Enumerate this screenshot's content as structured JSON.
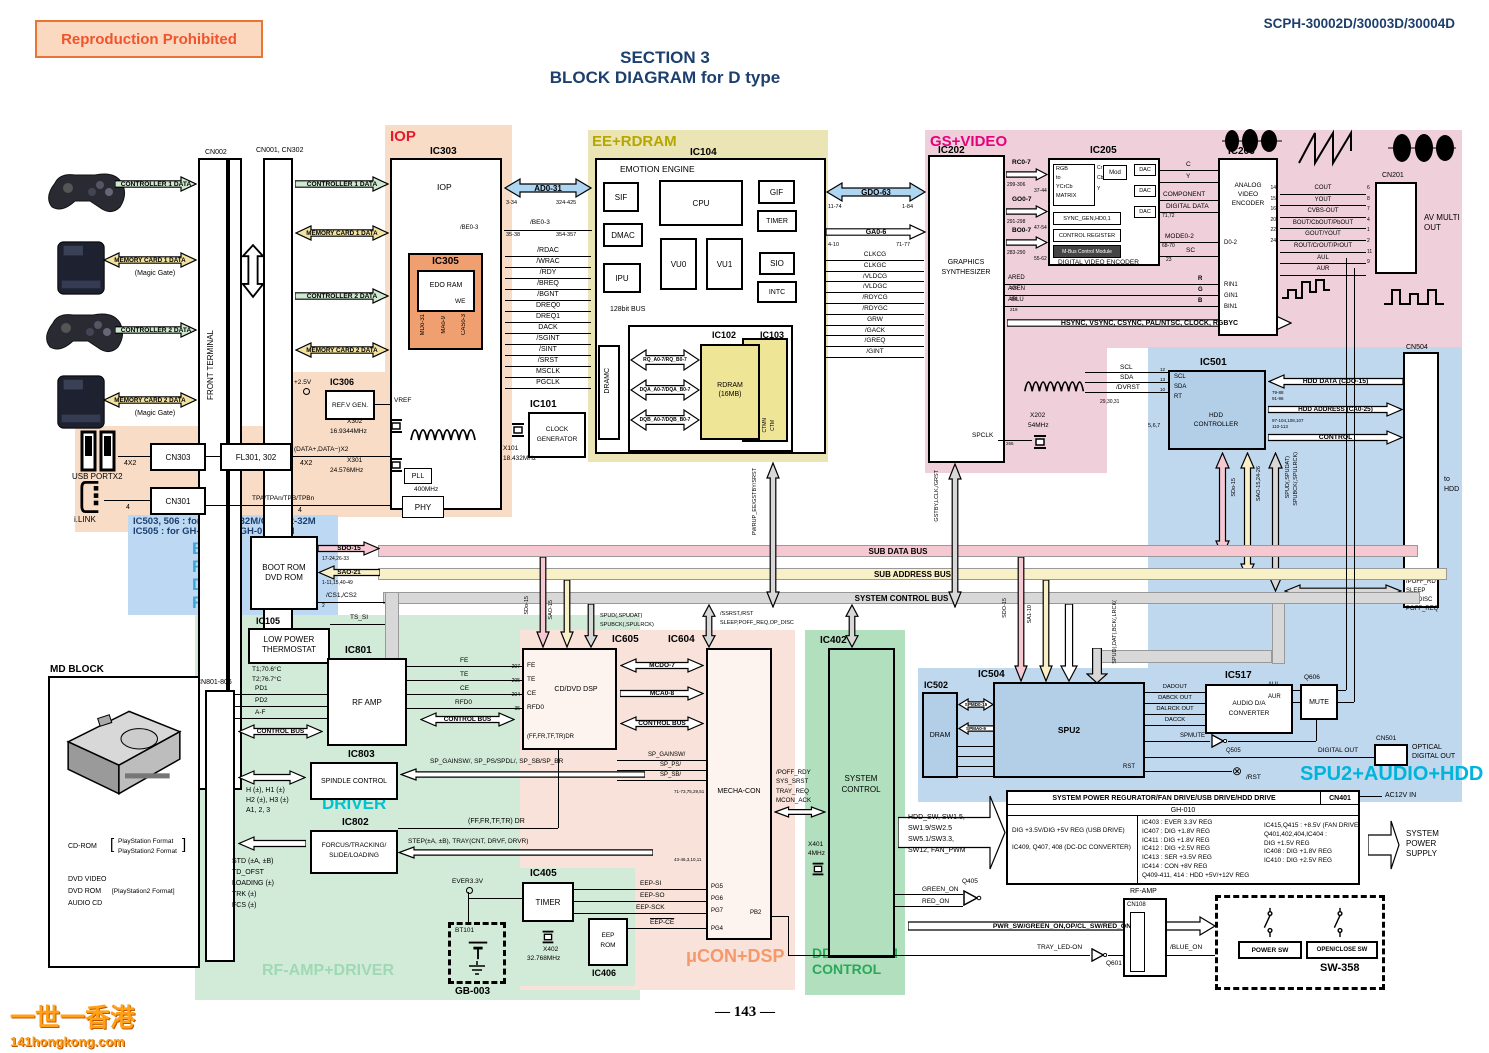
{
  "header": {
    "stamp": "Reproduction Prohibited",
    "model": "SCPH-30002D/30003D/30004D",
    "title1": "SECTION 3",
    "title2": "BLOCK DIAGRAM for D type",
    "page": "— 143 —",
    "wm1": "一世一香港",
    "wm2": "141hongkong.com"
  },
  "regions": {
    "iop": "IOP",
    "ee": "EE+RDRAM",
    "gs": "GS+VIDEO",
    "boot": [
      "BOOT",
      "ROM",
      "DVD",
      "ROM"
    ],
    "spu": "SPU2+AUDIO+HDD",
    "driver": "DRIVER",
    "rfamp": "RF-AMP+DRIVER",
    "ucon": "μCON+DSP",
    "dd1": "DD+SYSTEM",
    "dd2": "CONTROL",
    "note1": "IC503, 506 : for GH-010-32M/GH-012-32M",
    "note2": "IC505 :         for GH-010-64M/GH-012-64M"
  },
  "left": {
    "ctl1": "CONTROLLER 1 DATA",
    "mc1": "MEMORY CARD 1 DATA",
    "magic": "(Magic Gate)",
    "ctl2": "CONTROLLER 2 DATA",
    "mc2": "MEMORY CARD 2 DATA",
    "cn002": "CN002",
    "cn001": "CN001, CN302",
    "ft": "FRONT TERMINAL",
    "usb": "USB PORTX2",
    "ilink": "i.LINK",
    "cn303": "CN303",
    "fl": "FL301, 302",
    "cn301": "CN301",
    "datax2": "(DATA+,DATA−)X2",
    "x42": "4X2",
    "four": "4",
    "tpa": "TPA/TPAn/TPB/TPBn"
  },
  "iop": {
    "ic303": "IC303",
    "name": "IOP",
    "ic305": "IC305",
    "edo": "EDO RAM",
    "we": "WE",
    "md": "MDo-31",
    "ma": "MAo-9",
    "cas": "CASo-3",
    "vref": "VREF",
    "v25": "+2.5V",
    "ic306": "IC306",
    "refv": "REF.V GEN.",
    "x302": "X302",
    "x302f": "16.9344MHz",
    "x301": "X301",
    "x301f": "24.576MHz",
    "pll": "PLL",
    "mhz": "400MHz",
    "phy": "PHY",
    "ad": "AD0-31",
    "adp1": "3-34",
    "adp2": "324-425",
    "be": "/BE0-3",
    "bep1": "35-38",
    "bep3": "354-357",
    "signals": [
      "/RDAC",
      "/WRAC",
      "/RDY",
      "/BREQ",
      "/BGNT",
      "DREQ0",
      "DREQ1",
      "DACK",
      "/SGINT",
      "/SINT",
      "/SRST",
      "MSCLK",
      "PGCLK"
    ],
    "ic101": "IC101",
    "clk1": "CLOCK",
    "clk2": "GENERATOR",
    "x101": "X101",
    "x101f": "18.432MHz"
  },
  "ee": {
    "ic104": "IC104",
    "name": "EMOTION ENGINE",
    "sif": "SIF",
    "cpu": "CPU",
    "gif": "GIF",
    "timer": "TIMER",
    "dmac": "DMAC",
    "vu0": "VU0",
    "vu1": "VU1",
    "sio": "SIO",
    "ipu": "IPU",
    "intc": "INTC",
    "bus": "128bit BUS",
    "dramc": "DRAMC",
    "ic102": "IC102",
    "ic103": "IC103",
    "rdram1": "RDRAM",
    "rdram2": "(16MB)",
    "rq": "RQ_A0-7/RQ_B0-7",
    "dqa": "DQA_A0-7/DQA_B0-7",
    "dqb": "DQB_A0-7/DQB_B0-7",
    "ctmn": "CTMN",
    "ctm": "CTM"
  },
  "gsif": {
    "gdo": "GDO-63",
    "g1": "11-74",
    "g2": "1-84",
    "ga": "GA0-6",
    "g3": "4-10",
    "g4": "71-77",
    "signals": [
      "CLKCG",
      "CLKGC",
      "/VLDCG",
      "/VLDGC",
      "/RDYCG",
      "/RDYGC",
      "GRW",
      "/GACK",
      "/GREQ",
      "/GINT"
    ]
  },
  "gs": {
    "ic202": "IC202",
    "name1": "GRAPHICS",
    "name2": "SYNTHESIZER",
    "rc": "RC0-7",
    "rcp": "299-306",
    "rcp2": "37-44",
    "go": "GO0-7",
    "gop": "291-298",
    "gop2": "47-54",
    "bo": "BO0-7",
    "bop": "283-290",
    "bop2": "55-62",
    "ic205": "IC205",
    "mx1": "RGB",
    "mx2": "to",
    "mx3": "YCrCb",
    "mx4": "MATRIX",
    "mod": "Mod",
    "dac": "DAC",
    "cr": "Cr",
    "cb": "Cb",
    "yy": "Y",
    "sync": "SYNC_GEN,HD0,1",
    "creg": "CONTROL REGISTER",
    "mbus": "M-Bus Control Module",
    "dve": "DIGITAL VIDEO ENCODER",
    "oc": "C",
    "oy": "Y",
    "comp": "COMPONENT",
    "dd": "DIGITAL DATA",
    "ddp": "71,72",
    "mode": "MODE0-2",
    "modep": "68-70",
    "sc": "SC",
    "scp": "23",
    "p2931": "29,30,31",
    "ared": "ARED",
    "agen": "AGEN",
    "ablu": "ABLU",
    "ap1": "220",
    "ap2": "218",
    "ap3": "219",
    "r": "R",
    "g": "G",
    "b": "B",
    "hsync": "HSYNC, VSYNC, CSYNC, PAL/NTSC, CLOCK, RGBYC",
    "spclk": "SPCLK",
    "sp": "266",
    "x202": "X202",
    "x202f": "54MHz",
    "scl": "SCL",
    "sda": "SDA",
    "dvrst": "/DVRST"
  },
  "av": {
    "ic206": "IC206",
    "name1": "ANALOG",
    "name2": "VIDEO",
    "name3": "ENCODER",
    "d02": "D0-2",
    "rin": "RIN1",
    "gin": "GIN1",
    "bin": "BIN1",
    "outs": [
      "COUT",
      "YOUT",
      "CVBS-OUT",
      "BOUT/CbOUT/PbOUT",
      "GOUT/YOUT",
      "ROUT/CrOUT/PrOUT",
      "AUL",
      "AUR"
    ],
    "lp": [
      "14",
      "15",
      "16",
      "20",
      "22",
      "24"
    ],
    "cnp": [
      "6",
      "8",
      "7",
      "4",
      "1",
      "2",
      "11",
      "9"
    ],
    "cn201": "CN201",
    "avm1": "AV MULTI",
    "avm2": "OUT"
  },
  "hdd": {
    "ic501": "IC501",
    "name1": "HDD",
    "name2": "CONTROLLER",
    "scl": "SCL",
    "sda": "SDA",
    "rt": "RT",
    "p12": "12",
    "p13": "13",
    "p10": "10",
    "p567": "5,6,7",
    "data": "HDD DATA (CDO-15)",
    "datap": "79-88",
    "datap2": "91-96",
    "addr": "HDD ADDRESS (CA0-25)",
    "addrp": "97-104,108,107",
    "addrp2": "110-113",
    "ctl": "CONTROL",
    "cn504": "CN504",
    "to1": "to",
    "to2": "HDD",
    "sdo": "SDo-15",
    "sao": "SAO-15,24-26",
    "spud": "SPUD(,SPUDAT)",
    "spub": "SPUBCK(,SPULRCK)",
    "poff": [
      "/POFF_RDY",
      "SLEEP",
      "PO_DISC",
      "POFF_REQ"
    ]
  },
  "bus": {
    "data": "SUB DATA BUS",
    "addr": "SUB ADDRESS BUS",
    "ctl": "SYSTEM CONTROL BUS",
    "boot1": "BOOT ROM",
    "boot2": "DVD ROM",
    "sdo": "SDO-15",
    "sdop": "17-24,26-33",
    "sao": "SAO-21",
    "saop": "1-11,15,40-49",
    "cs": "/CS1,/CS2",
    "csp": "2",
    "tssi": "TS_SI",
    "pwrup": "PWRUP_EE/GSTBY/SRST",
    "gstby": "GSTBY,LCLK,/GRST",
    "sdo15": "SDo-15",
    "sao15": "SAO-15",
    "vsdo": "SDO-15",
    "vsa": "SA1-10",
    "vspud": "SPUD(,DAT(,BCK(,LRCK(",
    "spud605a": "SPUD(,SPUDAT)",
    "spud605b": "SPUBCK(,SPULRCK)",
    "ssrst": "/SSRST,/RST",
    "sleep": "SLEEP,POFF_REQ,OP_DISC"
  },
  "drv": {
    "ic105": "IC105",
    "lp1": "LOW POWER",
    "lp2": "THERMOSTAT",
    "t1": "T1;70.6°C",
    "t2": "T2;76.7°C",
    "cn801": "CN801-806",
    "ic801": "IC801",
    "rfamp": "RF AMP",
    "pd1": "PD1",
    "pd2": "PD2",
    "af": "A-F",
    "fe": "FE",
    "te": "TE",
    "ce": "CE",
    "rfd0": "RFD0",
    "cbus": "CONTROL BUS",
    "ic803": "IC803",
    "spindle": "SPINDLE CONTROL",
    "h1": "H (±), H1 (±)",
    "h2": "H2 (±), H3 (±)",
    "h3": "A1, 2, 3",
    "ic802": "IC802",
    "f1": "FORCUS/TRACKING/",
    "f2": "SLIDE/LOADING",
    "std": [
      "STD (±A, ±B)",
      "TD_OFST",
      "LOADING (±)",
      "TRK (±)",
      "FCS (±)"
    ],
    "spg": "SP_GAINSW/, SP_PS/SPDL/, SP_SB/SP_BR",
    "ffdr": "(FF,FR,TF,TR) DR",
    "step": "STEP(±A, ±B), TRAY(CNT, DRVF, DRVR)",
    "md": "MD BLOCK",
    "cdrom": "CD-ROM",
    "fmt1": "PlayStation Format",
    "fmt2": "PlayStation2 Format",
    "dvdv": "DVD VIDEO",
    "dvdr": "DVD ROM",
    "fmt3": "[PlayStation2 Format]",
    "acd": "AUDIO CD"
  },
  "dsp": {
    "ic605": "IC605",
    "name": "CD/DVD DSP",
    "fe": "FE",
    "te": "TE",
    "ce": "CE",
    "rfd0": "RFD0",
    "pins": [
      "207",
      "205",
      "204",
      "35"
    ],
    "ffdr": "(FF,FR,TF,TR)DR",
    "mcd": "MCDO-7",
    "mca": "MCA0-8",
    "cbus": "CONTROL BUS",
    "ic604": "IC604",
    "name2": "MECHA-CON",
    "p1": "71-73,75,29,51",
    "p2": "43-46,3,10,11",
    "spg1": "SP_GAINSW/",
    "spg2": "SP_PS/",
    "spg3": "SP_SB/",
    "poff": [
      "/POFF_RDY",
      "SYS_SRST",
      "TRAY_REQ",
      "MCON_ACK"
    ],
    "x401": "X401",
    "x401f": "4MHz",
    "pg5": "PG5",
    "pg6": "PG6",
    "pg7": "PG7",
    "pg4": "PG4",
    "pb2": "PB2",
    "eepsi": "EEP-SI",
    "eepso": "EEP-SO",
    "eepsck": "EEP-SCK",
    "eepce": "EEP-CE",
    "ic405": "IC405",
    "timer": "TIMER",
    "x402": "X402",
    "x402f": "32.768MHz",
    "ic406": "IC406",
    "eep1": "EEP",
    "eep2": "ROM",
    "bt": "BT101",
    "gb": "GB-003",
    "ever": "EVER3.3V"
  },
  "sys": {
    "ic402": "IC402",
    "n1": "SYSTEM",
    "n2": "CONTROL",
    "sw": [
      "HDD_SW, SW1.5,",
      "SW1.9/SW2.5",
      "SW5.1/SW3.3,",
      "SW12, FAN_PWM"
    ],
    "green": "GREEN_ON",
    "red": "RED_ON",
    "q405": "Q405",
    "pwr": "PWR_SW/GREEN_ON,OP/CL_SW/RED_ON",
    "tray": "TRAY_LED-ON",
    "q601": "Q601",
    "blue": "/BLUE_ON",
    "rfamp": "RF-AMP",
    "cn108": "CN108",
    "sw358": "SW-358",
    "psw": "POWER SW",
    "osw": "OPEN/CLOSE SW"
  },
  "spu": {
    "ic502": "IC502",
    "dram": "DRAM",
    "spmd": "SPMD0-15",
    "spma": "SPMA0-9",
    "we": "WE",
    "ras": "RAS",
    "cas": "CAS",
    "oe": "OE",
    "ic504": "IC504",
    "spu2": "SPU2",
    "rst": "RST",
    "ic517": "IC517",
    "n1": "AUDIO D/A",
    "n2": "CONVERTER",
    "ins": [
      "DADOUT",
      "DABCK OUT",
      "DALRCK OUT",
      "DACCK"
    ],
    "aul": "AUL",
    "aur": "AUR",
    "q606": "Q606",
    "mute": "MUTE",
    "spmute": "SPMUTE",
    "q505": "Q505",
    "dout": "DIGITAL OUT",
    "cn501": "CN501",
    "opt1": "OPTICAL",
    "opt2": "DIGITAL OUT",
    "rst2": "/RST"
  },
  "pwr": {
    "hdr": "SYSTEM POWER REGURATOR/FAN DRIVE/USB DRIVE/HDD DRIVE",
    "cn401": "CN401",
    "ac": "AC12V IN",
    "gh": "GH-010",
    "c1": [
      "DIG +3.5V/DIG +5V REG (USB DRIVE)",
      "IC409, Q407, 408 (DC-DC CONVERTER)"
    ],
    "c2": [
      "IC403 : EVER 3.3V REG",
      "IC407 : DIG +1.8V REG",
      "IC411 : DIG +1.8V REG",
      "IC412 : DIG +2.5V REG",
      "IC413 : SER +3.5V REG",
      "IC414 : CON +8V REG",
      "Q409-411, 414 : HDD +5V/+12V REG"
    ],
    "c3": [
      "IC415,Q415 : +8.5V (FAN DRIVE)",
      "Q401,402,404,IC404 :",
      "DIG +1.5V REG",
      "IC408 : DIG +1.8V REG",
      "IC410 : DIG +2.5V REG"
    ],
    "sps1": "SYSTEM",
    "sps2": "POWER",
    "sps3": "SUPPLY"
  }
}
